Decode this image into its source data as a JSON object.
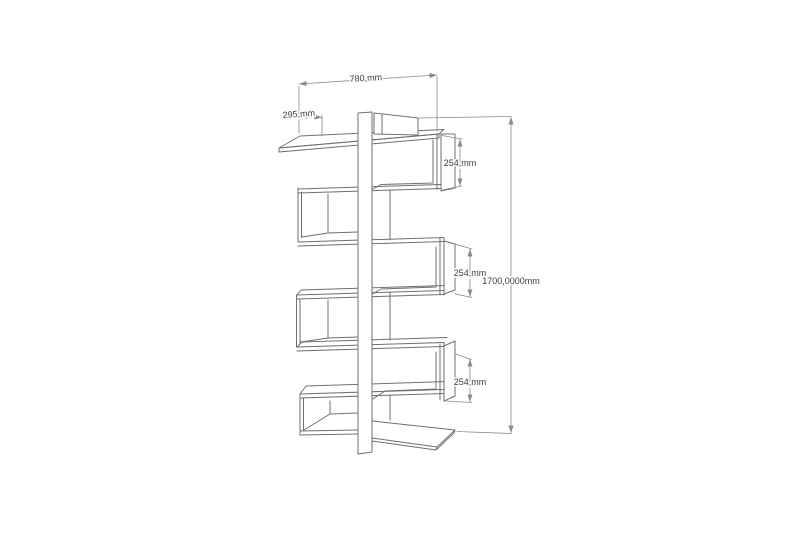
{
  "canvas": {
    "background": "#ffffff",
    "structure_line_color": "#6f6f6f",
    "dimension_line_color": "#8a8a8a",
    "dimension_text_color": "#3d3d3d"
  },
  "drawing": {
    "subject": "zigzag bookshelf technical drawing",
    "labels": {
      "width": "780,mm",
      "depth": "295,mm",
      "compartment_top": "254,mm",
      "compartment_middle": "254,mm",
      "compartment_bottom": "254,mm",
      "total_height": "1700,0000mm"
    }
  }
}
